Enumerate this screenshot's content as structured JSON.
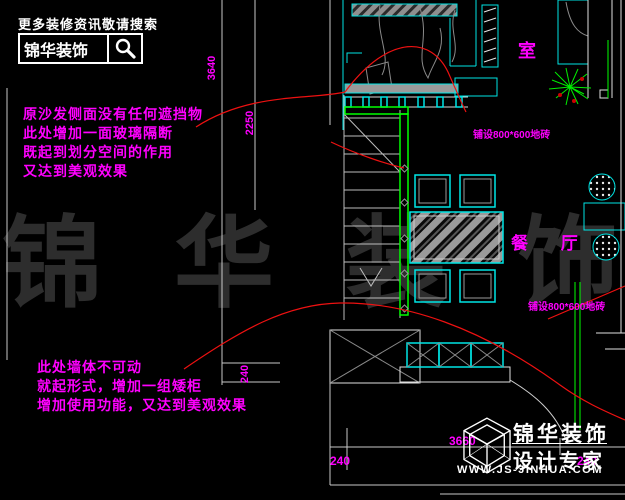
{
  "header": {
    "tagline": "更多装修资讯敬请搜索",
    "brand": "锦华装饰"
  },
  "watermark": "锦华装饰",
  "notes": {
    "glass_partition": [
      "原沙发侧面没有任何遮挡物",
      "此处增加一面玻璃隔断",
      "既起到划分空间的作用",
      "又达到美观效果"
    ],
    "low_cabinet": [
      "此处墙体不可动",
      "就起形式，增加一组矮柜",
      "增加使用功能，又达到美观效果"
    ]
  },
  "labels": {
    "dining_room": "餐 厅",
    "room_partial": "室",
    "tile_top": "铺设800*600地砖",
    "tile_bottom": "铺设800*600地砖"
  },
  "dimensions": {
    "v1": "3640",
    "v2": "2250",
    "v3": "240",
    "h1": "240",
    "h2": "3660",
    "h3": "240"
  },
  "logo": {
    "brand": "锦华装饰",
    "subtitle": "设计专家",
    "website": "WWW.JS-JINHUA.COM"
  },
  "colors": {
    "background": "#000000",
    "cad_cyan": "#00e5e5",
    "cad_green": "#00ff00",
    "leader_red": "#ff2020",
    "annotation_magenta": "#ff00ff",
    "text_white": "#ffffff",
    "watermark_gray": "#2d2d2d"
  }
}
